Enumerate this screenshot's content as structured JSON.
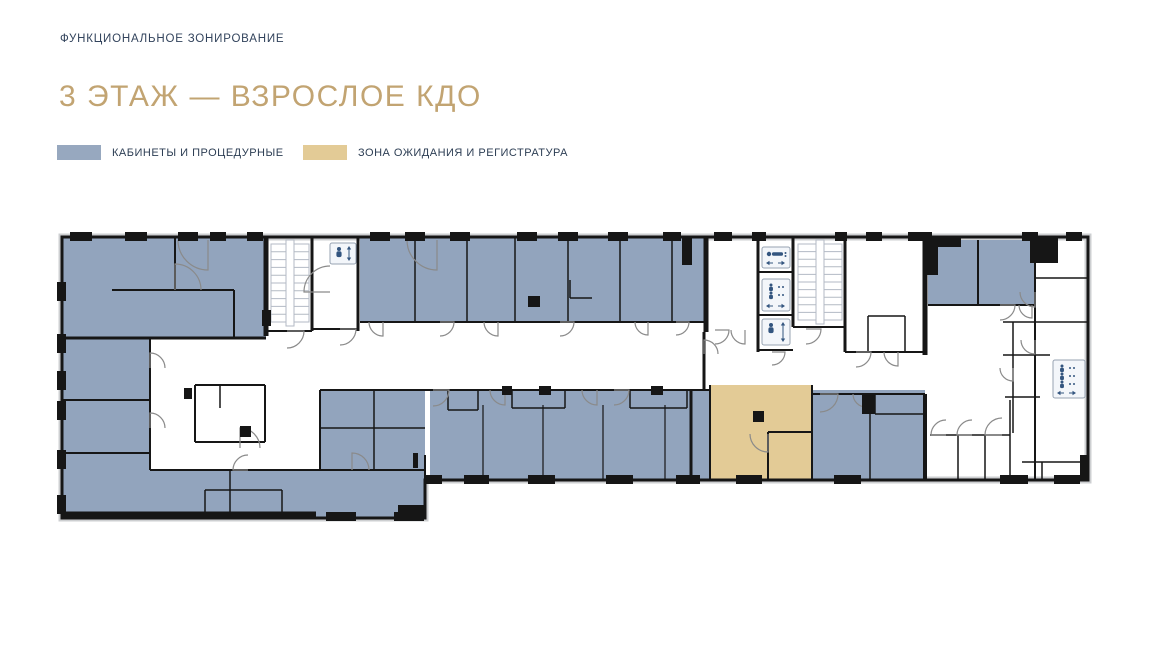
{
  "header": {
    "eyebrow": "ФУНКЦИОНАЛЬНОЕ ЗОНИРОВАНИЕ",
    "eyebrow_color": "#32435C",
    "title": "3 ЭТАЖ — ВЗРОСЛОЕ КДО",
    "title_color": "#C2A472"
  },
  "legend": {
    "items": [
      {
        "label": "КАБИНЕТЫ И ПРОЦЕДУРНЫЕ",
        "color": "#97A8BF"
      },
      {
        "label": "ЗОНА ОЖИДАНИЯ И РЕГИСТРАТУРА",
        "color": "#E3CB96"
      }
    ]
  },
  "floor_plan": {
    "colors": {
      "room_blue": "#92A4BD",
      "zone_tan": "#E3CB96",
      "white": "#FFFFFF",
      "wall": "#161616",
      "door": "#8A8A8A",
      "stair": "#B3BAC4",
      "frame": "#CDCFD1",
      "icon_bg": "#F3F6FA",
      "icon_border": "#97A3B2",
      "icon_fg": "#33557F"
    },
    "outline": "62,237 1088,237 1088,480 425,480 425,518 62,518",
    "regions": [
      {
        "name": "rooms-top-left-block",
        "x": 62,
        "y": 237,
        "w": 204,
        "h": 101,
        "fill": "room_blue"
      },
      {
        "name": "rooms-left-column",
        "x": 62,
        "y": 338,
        "w": 88,
        "h": 180,
        "fill": "room_blue"
      },
      {
        "name": "rooms-bottom-left-band",
        "x": 150,
        "y": 470,
        "w": 275,
        "h": 48,
        "fill": "room_blue"
      },
      {
        "name": "rooms-left-mid-block",
        "x": 320,
        "y": 390,
        "w": 105,
        "h": 80,
        "fill": "room_blue"
      },
      {
        "name": "rooms-top-band",
        "x": 360,
        "y": 237,
        "w": 346,
        "h": 85,
        "fill": "room_blue"
      },
      {
        "name": "rooms-bottom-mid-band",
        "x": 430,
        "y": 390,
        "w": 280,
        "h": 90,
        "fill": "room_blue"
      },
      {
        "name": "waiting-registration-zone",
        "x": 710,
        "y": 385,
        "w": 102,
        "h": 95,
        "fill": "zone_tan"
      },
      {
        "name": "rooms-right-of-waiting",
        "x": 812,
        "y": 390,
        "w": 113,
        "h": 90,
        "fill": "room_blue"
      },
      {
        "name": "rooms-top-right-a",
        "x": 928,
        "y": 240,
        "w": 50,
        "h": 65,
        "fill": "room_blue"
      },
      {
        "name": "rooms-top-right-b",
        "x": 978,
        "y": 240,
        "w": 57,
        "h": 65,
        "fill": "room_blue"
      }
    ],
    "walls": [
      [
        62,
        515,
        316,
        515,
        7
      ],
      [
        266,
        237,
        266,
        336,
        5
      ],
      [
        312,
        237,
        312,
        331,
        3
      ],
      [
        358,
        237,
        358,
        331,
        3
      ],
      [
        266,
        331,
        312,
        331,
        2
      ],
      [
        312,
        329,
        358,
        329,
        2
      ],
      [
        175,
        237,
        175,
        290,
        2
      ],
      [
        112,
        290,
        234,
        290,
        2
      ],
      [
        234,
        290,
        234,
        338,
        2
      ],
      [
        62,
        338,
        266,
        338,
        3
      ],
      [
        62,
        400,
        150,
        400,
        2
      ],
      [
        62,
        453,
        150,
        453,
        2
      ],
      [
        150,
        338,
        150,
        470,
        2
      ],
      [
        195,
        385,
        265,
        385,
        2
      ],
      [
        195,
        385,
        195,
        442,
        2
      ],
      [
        195,
        442,
        265,
        442,
        2
      ],
      [
        265,
        385,
        265,
        442,
        2
      ],
      [
        220,
        385,
        220,
        408,
        1.5
      ],
      [
        150,
        470,
        425,
        470,
        2
      ],
      [
        230,
        470,
        230,
        515,
        1.5
      ],
      [
        205,
        490,
        282,
        490,
        1.5
      ],
      [
        205,
        490,
        205,
        515,
        1.5
      ],
      [
        282,
        490,
        282,
        515,
        1.5
      ],
      [
        425,
        455,
        425,
        518,
        2
      ],
      [
        320,
        390,
        320,
        470,
        2
      ],
      [
        320,
        390,
        710,
        390,
        2
      ],
      [
        320,
        428,
        425,
        428,
        1.5
      ],
      [
        374,
        390,
        374,
        428,
        1.5
      ],
      [
        374,
        428,
        374,
        470,
        1.5
      ],
      [
        360,
        322,
        706,
        322,
        2
      ],
      [
        415,
        237,
        415,
        322,
        1.5
      ],
      [
        467,
        237,
        467,
        322,
        1.5
      ],
      [
        515,
        237,
        515,
        322,
        1.5
      ],
      [
        568,
        237,
        568,
        322,
        1.5
      ],
      [
        620,
        237,
        620,
        322,
        1.5
      ],
      [
        672,
        237,
        672,
        322,
        1.5
      ],
      [
        706,
        237,
        706,
        332,
        5
      ],
      [
        570,
        298,
        592,
        298,
        1.5
      ],
      [
        570,
        280,
        570,
        298,
        1.5
      ],
      [
        704,
        332,
        704,
        390,
        3
      ],
      [
        758,
        237,
        758,
        352,
        3
      ],
      [
        793,
        237,
        793,
        327,
        3
      ],
      [
        845,
        237,
        845,
        352,
        3
      ],
      [
        758,
        272,
        793,
        272,
        2
      ],
      [
        758,
        315,
        793,
        315,
        2
      ],
      [
        758,
        350,
        793,
        350,
        2
      ],
      [
        793,
        327,
        845,
        327,
        2
      ],
      [
        845,
        352,
        925,
        352,
        2
      ],
      [
        868,
        316,
        905,
        316,
        1.5
      ],
      [
        868,
        316,
        868,
        352,
        1.5
      ],
      [
        905,
        316,
        905,
        352,
        1.5
      ],
      [
        925,
        237,
        925,
        355,
        5
      ],
      [
        978,
        240,
        978,
        305,
        2
      ],
      [
        928,
        305,
        1035,
        305,
        2
      ],
      [
        1035,
        240,
        1035,
        480,
        2
      ],
      [
        1035,
        278,
        1088,
        278,
        1.5
      ],
      [
        1003,
        322,
        1088,
        322,
        1.5
      ],
      [
        1013,
        322,
        1013,
        433,
        1.5
      ],
      [
        1003,
        355,
        1050,
        355,
        1.5
      ],
      [
        1005,
        397,
        1040,
        397,
        1.5
      ],
      [
        710,
        385,
        710,
        480,
        2
      ],
      [
        768,
        432,
        768,
        480,
        2
      ],
      [
        768,
        432,
        812,
        432,
        2
      ],
      [
        812,
        385,
        812,
        480,
        2
      ],
      [
        812,
        394,
        925,
        394,
        2
      ],
      [
        870,
        394,
        870,
        480,
        1.5
      ],
      [
        875,
        394,
        875,
        414,
        1.5
      ],
      [
        875,
        414,
        925,
        414,
        1.5
      ],
      [
        925,
        394,
        925,
        480,
        4
      ],
      [
        483,
        405,
        483,
        480,
        1.2
      ],
      [
        543,
        405,
        543,
        480,
        1.2
      ],
      [
        603,
        405,
        603,
        480,
        1.2
      ],
      [
        665,
        405,
        665,
        480,
        1.2
      ],
      [
        448,
        390,
        448,
        410,
        1.5
      ],
      [
        478,
        390,
        478,
        410,
        1.5
      ],
      [
        448,
        410,
        478,
        410,
        1.5
      ],
      [
        512,
        390,
        512,
        408,
        1.5
      ],
      [
        565,
        390,
        565,
        408,
        1.5
      ],
      [
        512,
        408,
        565,
        408,
        1.5
      ],
      [
        630,
        390,
        630,
        408,
        1.5
      ],
      [
        687,
        390,
        687,
        408,
        1.5
      ],
      [
        630,
        408,
        687,
        408,
        1.5
      ],
      [
        691,
        390,
        691,
        480,
        3
      ],
      [
        930,
        435,
        1010,
        435,
        1.5
      ],
      [
        958,
        435,
        958,
        480,
        1.5
      ],
      [
        985,
        435,
        985,
        480,
        1.5
      ],
      [
        1010,
        400,
        1010,
        480,
        1.5
      ],
      [
        1022,
        462,
        1088,
        462,
        1.5
      ],
      [
        1042,
        462,
        1042,
        480,
        1.5
      ]
    ],
    "doors": [
      [
        287,
        331,
        17,
        0,
        90
      ],
      [
        340,
        329,
        16,
        0,
        90
      ],
      [
        383,
        322,
        14,
        90,
        180
      ],
      [
        440,
        322,
        14,
        0,
        90
      ],
      [
        498,
        322,
        14,
        90,
        180
      ],
      [
        560,
        322,
        14,
        0,
        90
      ],
      [
        648,
        322,
        13,
        90,
        180
      ],
      [
        676,
        322,
        13,
        0,
        90
      ],
      [
        704,
        354,
        14,
        270,
        360
      ],
      [
        715,
        330,
        14,
        0,
        90
      ],
      [
        745,
        330,
        14,
        90,
        180
      ],
      [
        772,
        352,
        13,
        0,
        90
      ],
      [
        806,
        329,
        15,
        0,
        90
      ],
      [
        856,
        352,
        15,
        0,
        90
      ],
      [
        898,
        352,
        14,
        90,
        180
      ],
      [
        208,
        240,
        30,
        90,
        180
      ],
      [
        175,
        290,
        26,
        270,
        360
      ],
      [
        330,
        292,
        26,
        180,
        270
      ],
      [
        437,
        240,
        30,
        90,
        180
      ],
      [
        150,
        368,
        15,
        270,
        360
      ],
      [
        150,
        428,
        15,
        270,
        360
      ],
      [
        240,
        448,
        20,
        270,
        360
      ],
      [
        248,
        470,
        15,
        180,
        270
      ],
      [
        352,
        470,
        17,
        270,
        360
      ],
      [
        433,
        390,
        16,
        0,
        90
      ],
      [
        505,
        390,
        15,
        90,
        180
      ],
      [
        597,
        390,
        15,
        90,
        180
      ],
      [
        614,
        390,
        15,
        0,
        90
      ],
      [
        768,
        434,
        18,
        90,
        180
      ],
      [
        820,
        394,
        18,
        0,
        90
      ],
      [
        866,
        394,
        13,
        90,
        180
      ],
      [
        1000,
        305,
        15,
        0,
        90
      ],
      [
        1032,
        305,
        13,
        90,
        180
      ],
      [
        946,
        435,
        15,
        180,
        270
      ],
      [
        972,
        435,
        15,
        180,
        270
      ],
      [
        1002,
        435,
        17,
        180,
        270
      ],
      [
        1035,
        292,
        15,
        90,
        180
      ],
      [
        1035,
        340,
        14,
        90,
        180
      ],
      [
        1013,
        368,
        13,
        90,
        180
      ]
    ],
    "stairs": [
      {
        "x": 271,
        "y": 244,
        "w": 38,
        "h": 78,
        "treads": 10
      },
      {
        "x": 798,
        "y": 244,
        "w": 44,
        "h": 76,
        "treads": 10
      }
    ],
    "elevators": [
      {
        "x": 330,
        "y": 243,
        "w": 26,
        "h": 21,
        "type": "person-updown"
      },
      {
        "x": 762,
        "y": 247,
        "w": 28,
        "h": 21,
        "type": "bed-lr"
      },
      {
        "x": 762,
        "y": 279,
        "w": 28,
        "h": 32,
        "type": "people-lr"
      },
      {
        "x": 762,
        "y": 319,
        "w": 28,
        "h": 26,
        "type": "person-updown"
      },
      {
        "x": 1053,
        "y": 360,
        "w": 32,
        "h": 38,
        "type": "people-lr"
      }
    ],
    "marks": [
      [
        70,
        232,
        22,
        9
      ],
      [
        125,
        232,
        22,
        9
      ],
      [
        178,
        232,
        20,
        9
      ],
      [
        210,
        232,
        16,
        9
      ],
      [
        247,
        232,
        16,
        9
      ],
      [
        370,
        232,
        20,
        9
      ],
      [
        405,
        232,
        20,
        9
      ],
      [
        450,
        232,
        20,
        9
      ],
      [
        517,
        232,
        20,
        9
      ],
      [
        558,
        232,
        20,
        9
      ],
      [
        608,
        232,
        20,
        9
      ],
      [
        663,
        232,
        18,
        9
      ],
      [
        714,
        232,
        18,
        9
      ],
      [
        752,
        232,
        14,
        9
      ],
      [
        835,
        232,
        12,
        9
      ],
      [
        866,
        232,
        16,
        9
      ],
      [
        908,
        232,
        24,
        9
      ],
      [
        1022,
        232,
        16,
        9
      ],
      [
        1066,
        232,
        16,
        9
      ],
      [
        57,
        282,
        9,
        19
      ],
      [
        57,
        334,
        9,
        19
      ],
      [
        57,
        371,
        9,
        19
      ],
      [
        57,
        401,
        9,
        19
      ],
      [
        57,
        450,
        9,
        19
      ],
      [
        57,
        495,
        9,
        19
      ],
      [
        326,
        512,
        30,
        9
      ],
      [
        394,
        512,
        30,
        9
      ],
      [
        425,
        475,
        17,
        9
      ],
      [
        464,
        475,
        25,
        9
      ],
      [
        528,
        475,
        27,
        9
      ],
      [
        606,
        475,
        27,
        9
      ],
      [
        676,
        475,
        24,
        9
      ],
      [
        736,
        475,
        26,
        9
      ],
      [
        834,
        475,
        27,
        9
      ],
      [
        1000,
        475,
        28,
        9
      ],
      [
        1054,
        475,
        26,
        9
      ],
      [
        1080,
        455,
        9,
        25
      ],
      [
        262,
        310,
        9,
        16
      ],
      [
        528,
        296,
        12,
        11
      ],
      [
        240,
        426,
        11,
        11
      ],
      [
        184,
        388,
        8,
        11
      ],
      [
        753,
        411,
        11,
        11
      ],
      [
        862,
        394,
        13,
        20
      ],
      [
        539,
        386,
        12,
        9
      ],
      [
        651,
        386,
        12,
        9
      ],
      [
        502,
        386,
        10,
        9
      ],
      [
        925,
        237,
        36,
        10
      ],
      [
        925,
        237,
        13,
        38
      ],
      [
        1030,
        237,
        28,
        26
      ],
      [
        682,
        237,
        10,
        28
      ],
      [
        413,
        453,
        5,
        15
      ],
      [
        398,
        505,
        26,
        10
      ]
    ]
  }
}
